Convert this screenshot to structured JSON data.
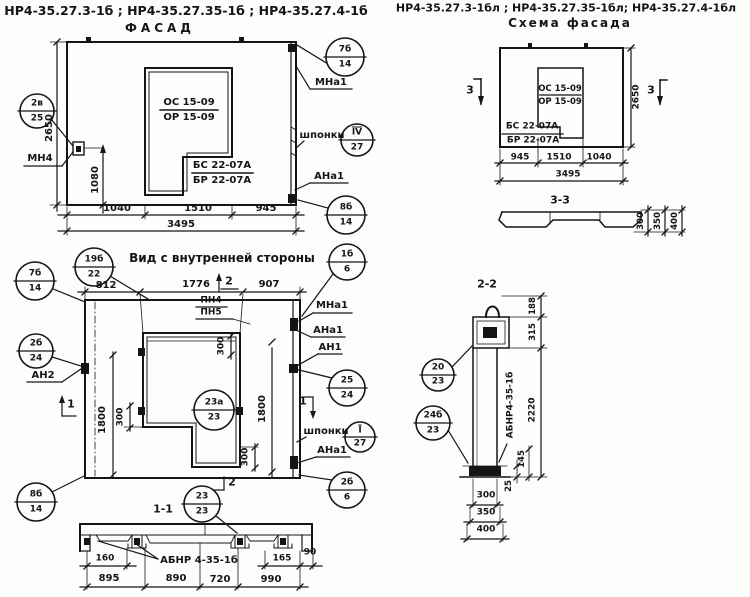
{
  "header": {
    "left_codes": "НР4-35.27.3-1б ;  НР4-35.27.35-1б ;  НР4-35.27.4-1б",
    "facade_title": "ФАСАД",
    "right_codes": "НР4-35.27.3-1бл ;  НР4-35.27.35-1бл;  НР4-35.27.4-1бл",
    "schema_title": "Схема фасада"
  },
  "facade": {
    "window_mark_top": "ОС 15-09",
    "window_mark_bot": "ОР 15-09",
    "block_mark_top": "БС 22-07А",
    "block_mark_bot": "БР 22-07А",
    "dim_w1": "1040",
    "dim_w2": "1510",
    "dim_w3": "945",
    "dim_total": "3495",
    "dim_height": "2650",
    "dim_inner": "1080",
    "label_mn4": "МН4",
    "label_mna1": "МНа1",
    "label_shponki": "шпонки",
    "label_ana1": "АНа1",
    "callout_left": {
      "top": "2в",
      "bot": "25"
    },
    "callout_tr": {
      "top": "7б",
      "bot": "14"
    },
    "callout_key": {
      "top": "IV",
      "bot": "27"
    },
    "callout_br": {
      "top": "8б",
      "bot": "14"
    }
  },
  "inner_view": {
    "title": "Вид с внутренней стороны",
    "dim_top1": "812",
    "dim_top2": "1776",
    "dim_top3": "907",
    "label_pn4": "ПН4",
    "label_pn5": "ПН5",
    "label_mna1": "МНа1",
    "label_ana1_top": "АНа1",
    "label_an1": "АН1",
    "label_an2": "АН2",
    "label_shponki": "шпонки",
    "label_ana1_bot": "АНа1",
    "dim_300_top": "300",
    "dim_300_left": "300",
    "dim_300_bot": "300",
    "dim_1800_left": "1800",
    "dim_1800_right": "1800",
    "sec1": "1",
    "sec2": "2",
    "callout_19b": {
      "top": "19б",
      "bot": "22"
    },
    "callout_7b": {
      "top": "7б",
      "bot": "14"
    },
    "callout_2b24": {
      "top": "2б",
      "bot": "24"
    },
    "callout_8b": {
      "top": "8б",
      "bot": "14"
    },
    "callout_1b6": {
      "top": "1б",
      "bot": "6"
    },
    "callout_25": {
      "top": "25",
      "bot": "24"
    },
    "callout_key": {
      "top": "I",
      "bot": "27"
    },
    "callout_2b6": {
      "top": "2б",
      "bot": "6"
    },
    "callout_23a": {
      "top": "23а",
      "bot": "23"
    }
  },
  "section_1_1": {
    "title": "1-1",
    "callout": {
      "top": "23",
      "bot": "23"
    },
    "label_panel": "АБНР 4-35-1б",
    "dim_160": "160",
    "dim_165": "165",
    "dim_90": "90",
    "dims_bottom": [
      "895",
      "890",
      "720",
      "990"
    ]
  },
  "schema": {
    "window_mark_top": "ОС 15-09",
    "window_mark_bot": "ОР 15-09",
    "block_mark_top": "БС 22-07А",
    "block_mark_bot": "БР 22-07А",
    "dim_w1": "945",
    "dim_w2": "1510",
    "dim_w3": "1040",
    "dim_total": "3495",
    "dim_height": "2650",
    "sec3": "3",
    "section_title": "3-3",
    "dims_33": [
      "300",
      "350",
      "400"
    ]
  },
  "section_2_2": {
    "title": "2-2",
    "dim_188": "188",
    "dim_315": "315",
    "dim_2220": "2220",
    "dim_145": "145",
    "dim_25": "25",
    "dims_bottom": [
      "300",
      "350",
      "400"
    ],
    "label_panel": "АБНР4-35-1б",
    "callout_20": {
      "top": "20",
      "bot": "23"
    },
    "callout_24b": {
      "top": "24б",
      "bot": "23"
    }
  }
}
